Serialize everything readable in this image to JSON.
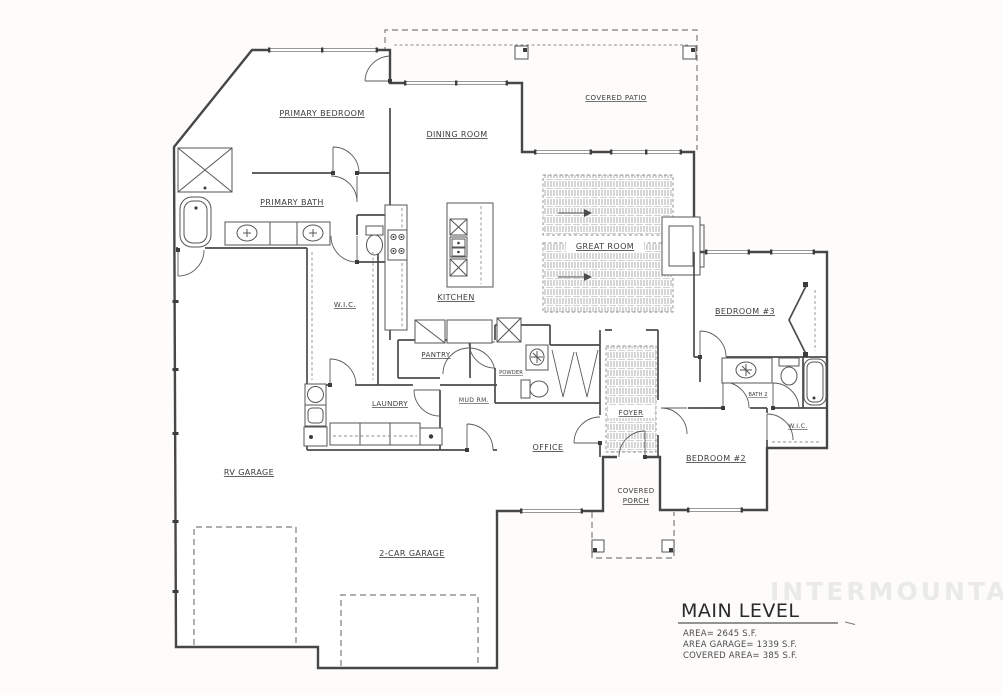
{
  "plan": {
    "watermark": "INTERMOUNTAIN",
    "rooms": {
      "primary_bedroom": "PRIMARY BEDROOM",
      "primary_bath": "PRIMARY BATH",
      "wic_primary": "W.I.C.",
      "dining_room": "DINING ROOM",
      "covered_patio": "COVERED PATIO",
      "great_room": "GREAT ROOM",
      "kitchen": "KITCHEN",
      "pantry": "PANTRY",
      "powder": "POWDER",
      "laundry": "LAUNDRY",
      "mud_room": "MUD RM.",
      "office": "OFFICE",
      "foyer": "FOYER",
      "bedroom_3": "BEDROOM #3",
      "bath_2": "BATH 2",
      "wic_2": "W.I.C.",
      "bedroom_2": "BEDROOM #2",
      "covered_porch_line1": "COVERED",
      "covered_porch_line2": "PORCH",
      "rv_garage": "RV GARAGE",
      "two_car_garage": "2-CAR GARAGE"
    },
    "title_block": {
      "title": "MAIN LEVEL",
      "stats": [
        "AREA= 2645 S.F.",
        "AREA GARAGE= 1339 S.F.",
        "COVERED AREA= 385 S.F."
      ]
    },
    "colors": {
      "wall": "#474747",
      "label": "#3b3b3b",
      "dashed": "#7d7d7d",
      "hatch": "#9a9a9a",
      "watermark": "#eaeae8",
      "sheet_background": "#fdfcfb"
    }
  }
}
